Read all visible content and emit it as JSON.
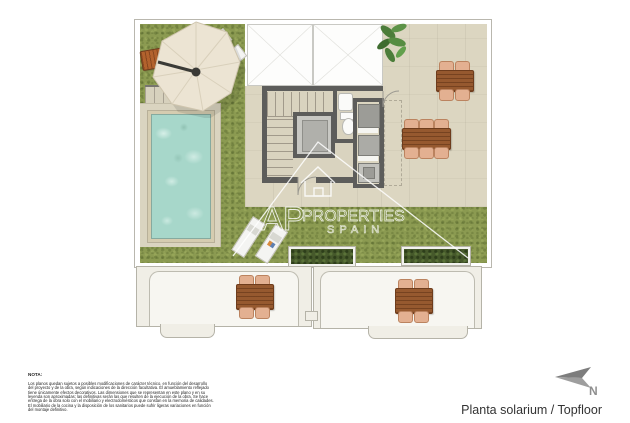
{
  "watermark": {
    "brand_top": "AP",
    "brand_mid": "PROPERTIES",
    "brand_bottom": "SPAIN"
  },
  "footer": {
    "plan_title": "Planta solarium / Topfloor",
    "compass_label": "N"
  },
  "note": {
    "heading": "NOTA:",
    "lines": [
      "Los planos quedan sujetos a posibles modificaciones de carácter técnico, en función del desarrollo",
      "del proyecto y de la obra, según indicaciones de la dirección facultativa. El amueblamiento reflejado",
      "tiene únicamente efectos decorativos. Las dimensiones que se representan en este plano y en su",
      "leyenda son aproximadas; las definitivas serán las que resulten de la ejecución de la obra. Se hace",
      "entrega de la obra solo con el mobiliario y electrodomésticos que constan en la memoria de calidades.",
      "El mobiliario de la cocina y la disposición de los sanitarios puede sufrir ligeras variaciones en función",
      "del montaje definitivo."
    ]
  },
  "colors": {
    "grass": "#8b9a51",
    "terrace_beige": "#dcd6c1",
    "pool_water": "#a7d7ca",
    "wall_gray": "#5d5d5b",
    "wood_brown": "#96592f",
    "chair_tan": "#e3b091",
    "hedge_green": "#46592b",
    "outline_gray": "#b5b3a8",
    "compass_gray": "#8f8f8f"
  }
}
